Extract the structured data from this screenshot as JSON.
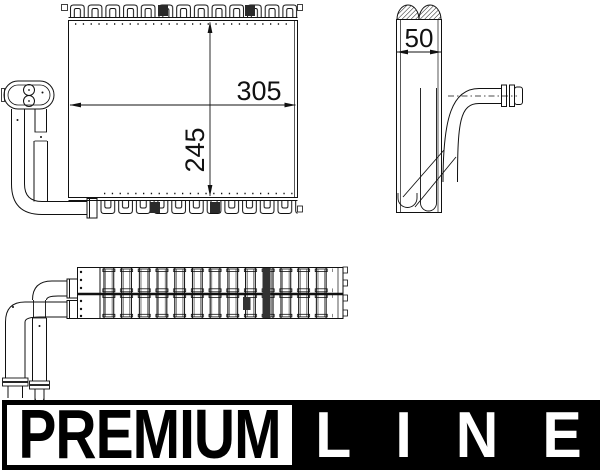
{
  "canvas": {
    "background": "#ffffff",
    "line_color": "#111111"
  },
  "drawing": {
    "front_view": {
      "width_label": "305",
      "height_label": "245"
    },
    "side_view": {
      "depth_label": "50"
    }
  },
  "logo": {
    "premium": "PREMIUM",
    "line": "LINE",
    "foreground": "#000000",
    "background": "#ffffff"
  }
}
